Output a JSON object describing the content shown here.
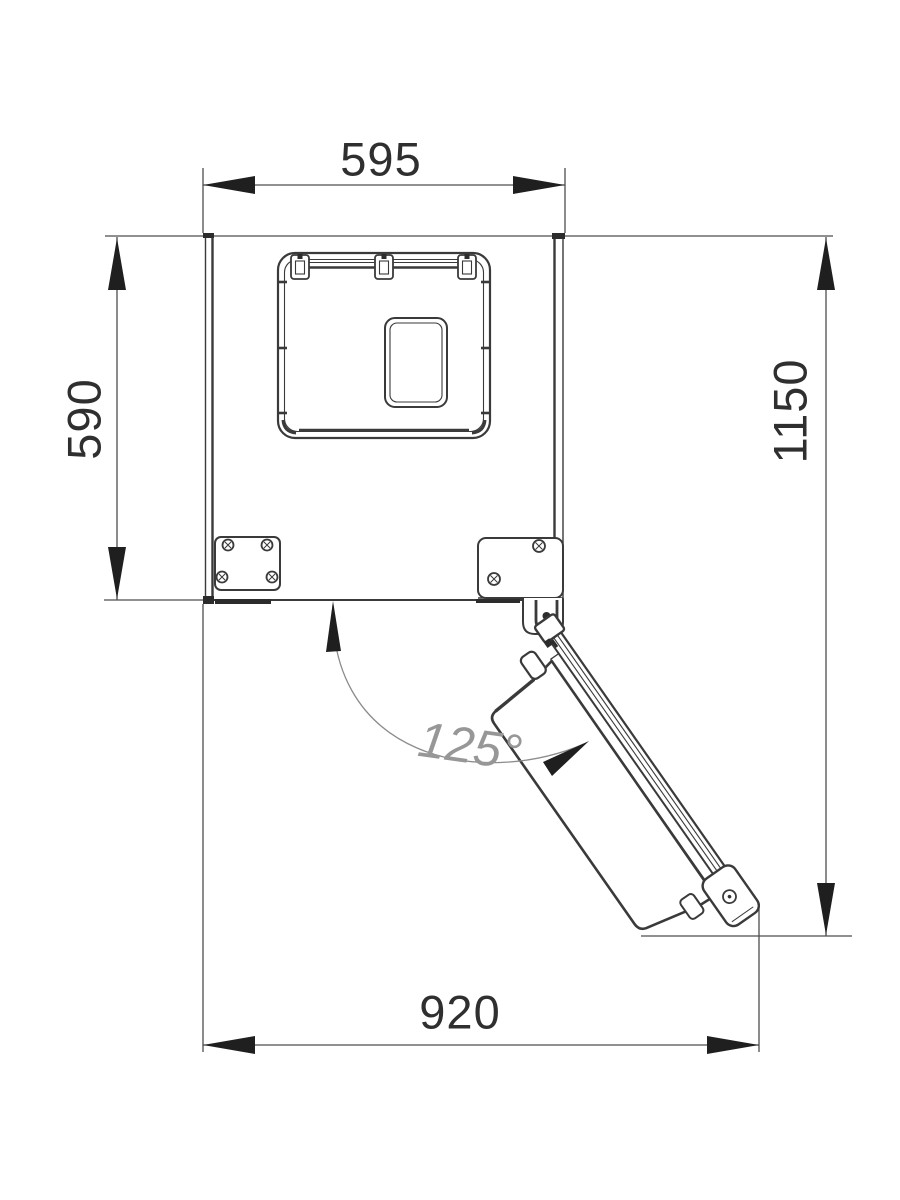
{
  "drawing": {
    "type": "technical-dimension-drawing",
    "subject": "refrigerator top view with door opened",
    "dimensions": {
      "cabinet_width": "595",
      "cabinet_depth": "590",
      "depth_with_open_door": "1150",
      "width_with_open_door": "920",
      "door_opening_angle": "125°"
    },
    "colors": {
      "background": "#ffffff",
      "outline": "#3a3a3a",
      "dimension_line": "#4d4d4d",
      "arrow_fill": "#1f1f1f",
      "arc": "#8c8c8c",
      "label_text": "#2f2f2f",
      "angle_text": "#979797"
    }
  }
}
